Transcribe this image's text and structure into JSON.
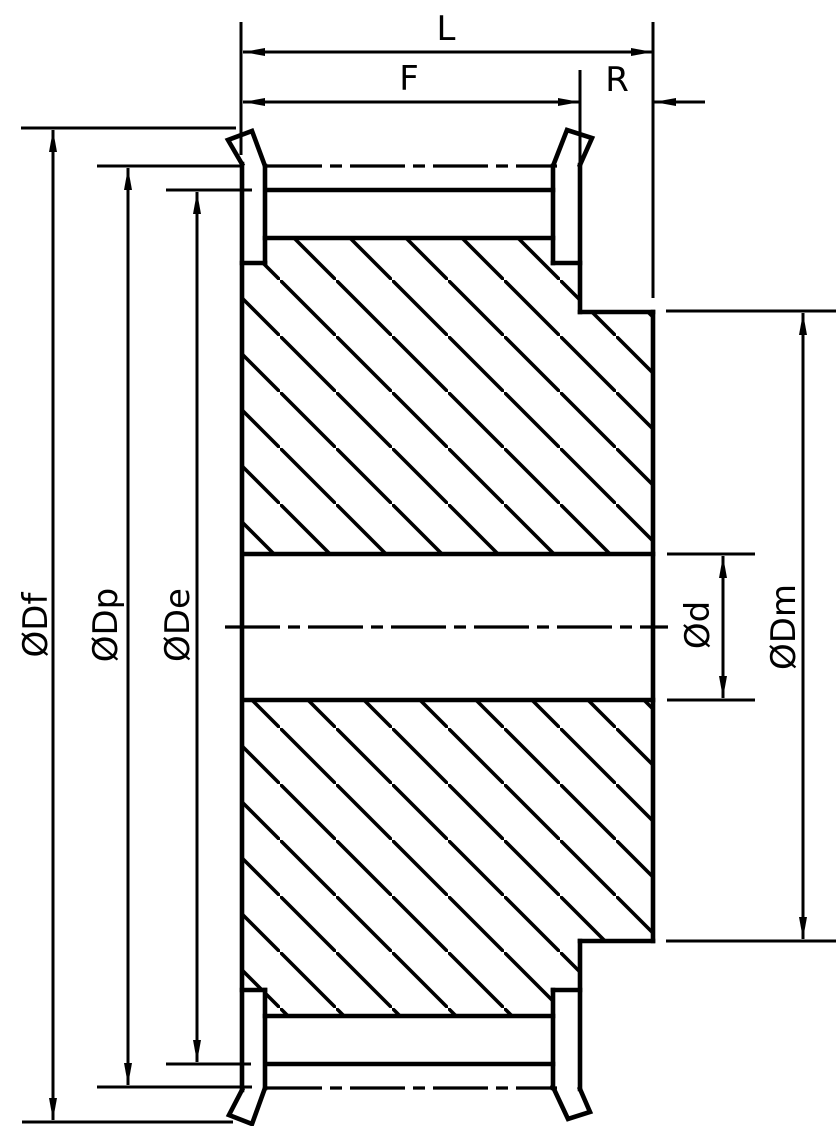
{
  "page": {
    "background_color": "#ffffff",
    "line_color": "#000000"
  },
  "drawing": {
    "labels": {
      "overall_width": "L",
      "face_width": "F",
      "hub_projection": "R",
      "flange_diameter": "ØDf",
      "pitch_diameter": "ØDp",
      "outside_diameter": "ØDe",
      "bore_diameter": "Ød",
      "hub_diameter": "ØDm"
    }
  }
}
